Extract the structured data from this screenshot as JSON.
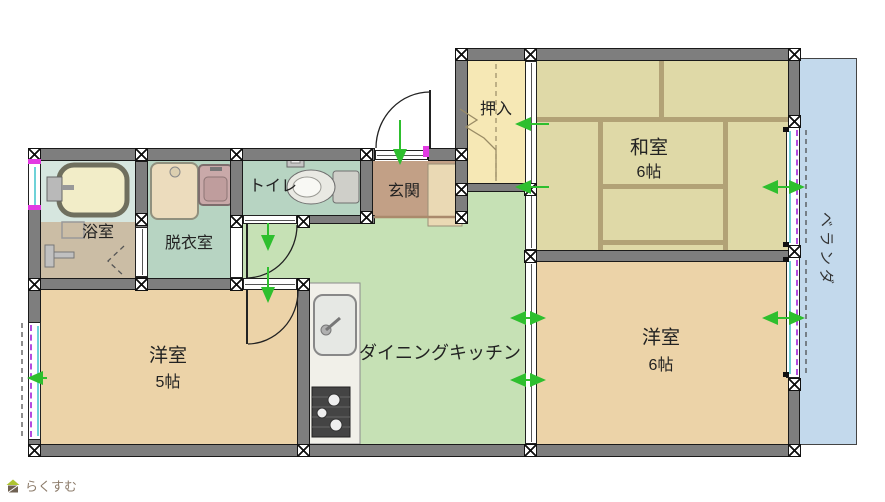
{
  "plan": {
    "rooms": {
      "bath": {
        "label": "浴室"
      },
      "dressing": {
        "label": "脱衣室"
      },
      "toilet": {
        "label": "トイレ"
      },
      "entrance": {
        "label": "玄関"
      },
      "closet": {
        "label": "押入"
      },
      "japanese_room": {
        "label": "和室",
        "size": "6帖"
      },
      "dining_kitchen": {
        "label": "ダイニングキッチン"
      },
      "western_room_5": {
        "label": "洋室",
        "size": "5帖"
      },
      "western_room_6": {
        "label": "洋室",
        "size": "6帖"
      },
      "veranda": {
        "label": "ベランダ"
      }
    },
    "branding": {
      "logo_text": "らくすむ"
    },
    "colors": {
      "wall": "#7e7e7e",
      "tatami": "#dfd9a7",
      "tatami_border": "#b2a276",
      "western_floor": "#ecd3a8",
      "dk_floor": "#c6e1b5",
      "wet_area_floor": "#b7d4c2",
      "entrance_floor": "#c2a086",
      "closet_floor": "#f6e8b5",
      "veranda": "#c3d9ec",
      "door_arrow_green": "#2ebf2e",
      "window_marker_magenta": "#e23ae2",
      "window_dash_purple": "#b44ce0"
    }
  }
}
